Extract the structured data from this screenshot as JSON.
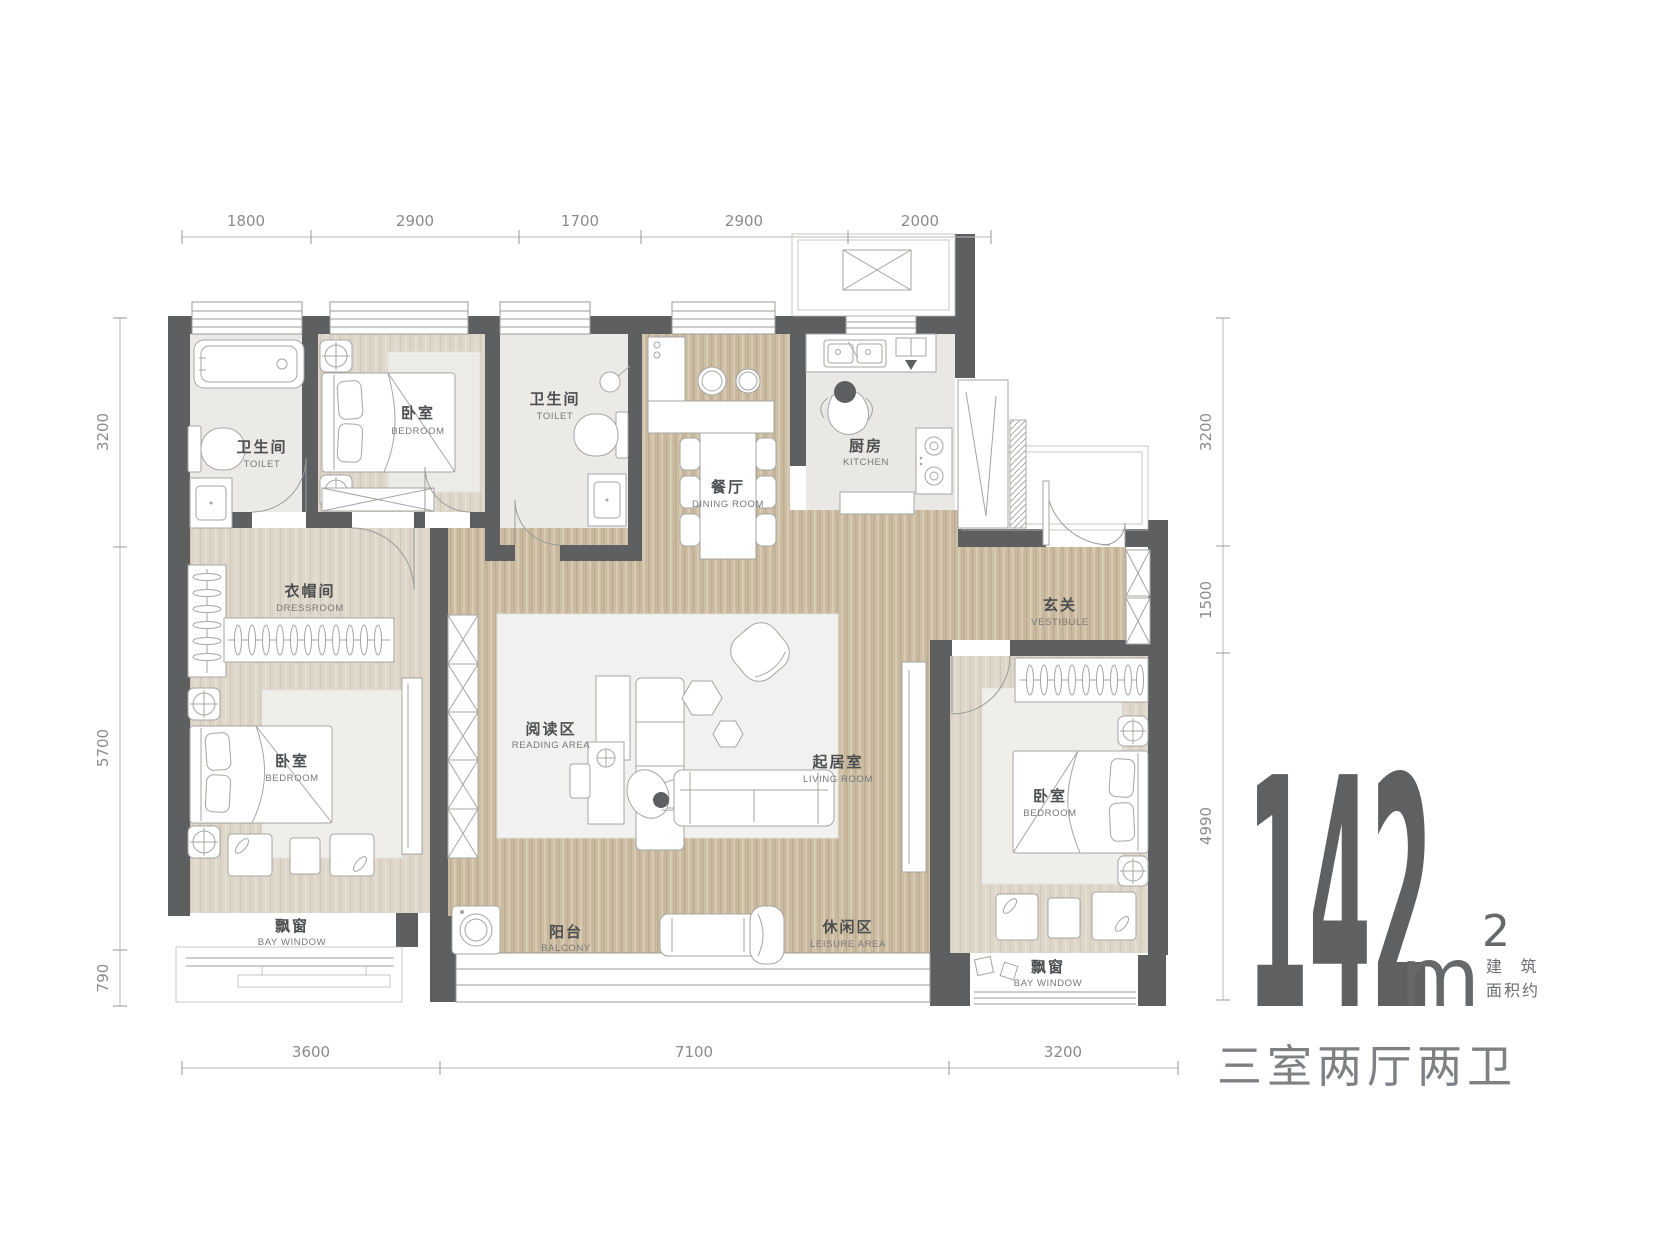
{
  "area": {
    "value": "142",
    "unit": "m",
    "sup": "2",
    "note1": "建 筑",
    "note2": "面积约",
    "layout": "三室两厅两卫"
  },
  "dims": {
    "top": [
      "1800",
      "2900",
      "1700",
      "2900",
      "2000"
    ],
    "bottom": [
      "3600",
      "7100",
      "3200"
    ],
    "left": [
      "3200",
      "5700",
      "790"
    ],
    "right": [
      "3200",
      "1500",
      "4990"
    ]
  },
  "rooms": {
    "toilet1": {
      "zh": "卫生间",
      "en": "TOILET"
    },
    "bedroom_top": {
      "zh": "卧室",
      "en": "BEDROOM"
    },
    "toilet2": {
      "zh": "卫生间",
      "en": "TOILET"
    },
    "dining": {
      "zh": "餐厅",
      "en": "DINING ROOM"
    },
    "kitchen": {
      "zh": "厨房",
      "en": "KITCHEN"
    },
    "vestibule": {
      "zh": "玄关",
      "en": "VESTIBULE"
    },
    "dressroom": {
      "zh": "衣帽间",
      "en": "DRESSROOM"
    },
    "bedroom_left": {
      "zh": "卧室",
      "en": "BEDROOM"
    },
    "reading": {
      "zh": "阅读区",
      "en": "READING AREA"
    },
    "living": {
      "zh": "起居室",
      "en": "LIVING ROOM"
    },
    "balcony": {
      "zh": "阳台",
      "en": "BALCONY"
    },
    "leisure": {
      "zh": "休闲区",
      "en": "LEISURE AREA"
    },
    "bay_left": {
      "zh": "飘窗",
      "en": "BAY WINDOW"
    },
    "bay_right": {
      "zh": "飘窗",
      "en": "BAY WINDOW"
    },
    "bedroom_right": {
      "zh": "卧室",
      "en": "BEDROOM"
    }
  },
  "colors": {
    "wall": "#5d5f60",
    "wood_floor": "#cdbfa5",
    "bedroom_floor": "#ded6c9",
    "tile_floor": "#ebeae6",
    "rug": "#f1f1ef",
    "big_text": "#5f6062",
    "dim_text": "#8b8b8b",
    "label_zh": "#4d4e50",
    "label_en": "#77787a"
  }
}
